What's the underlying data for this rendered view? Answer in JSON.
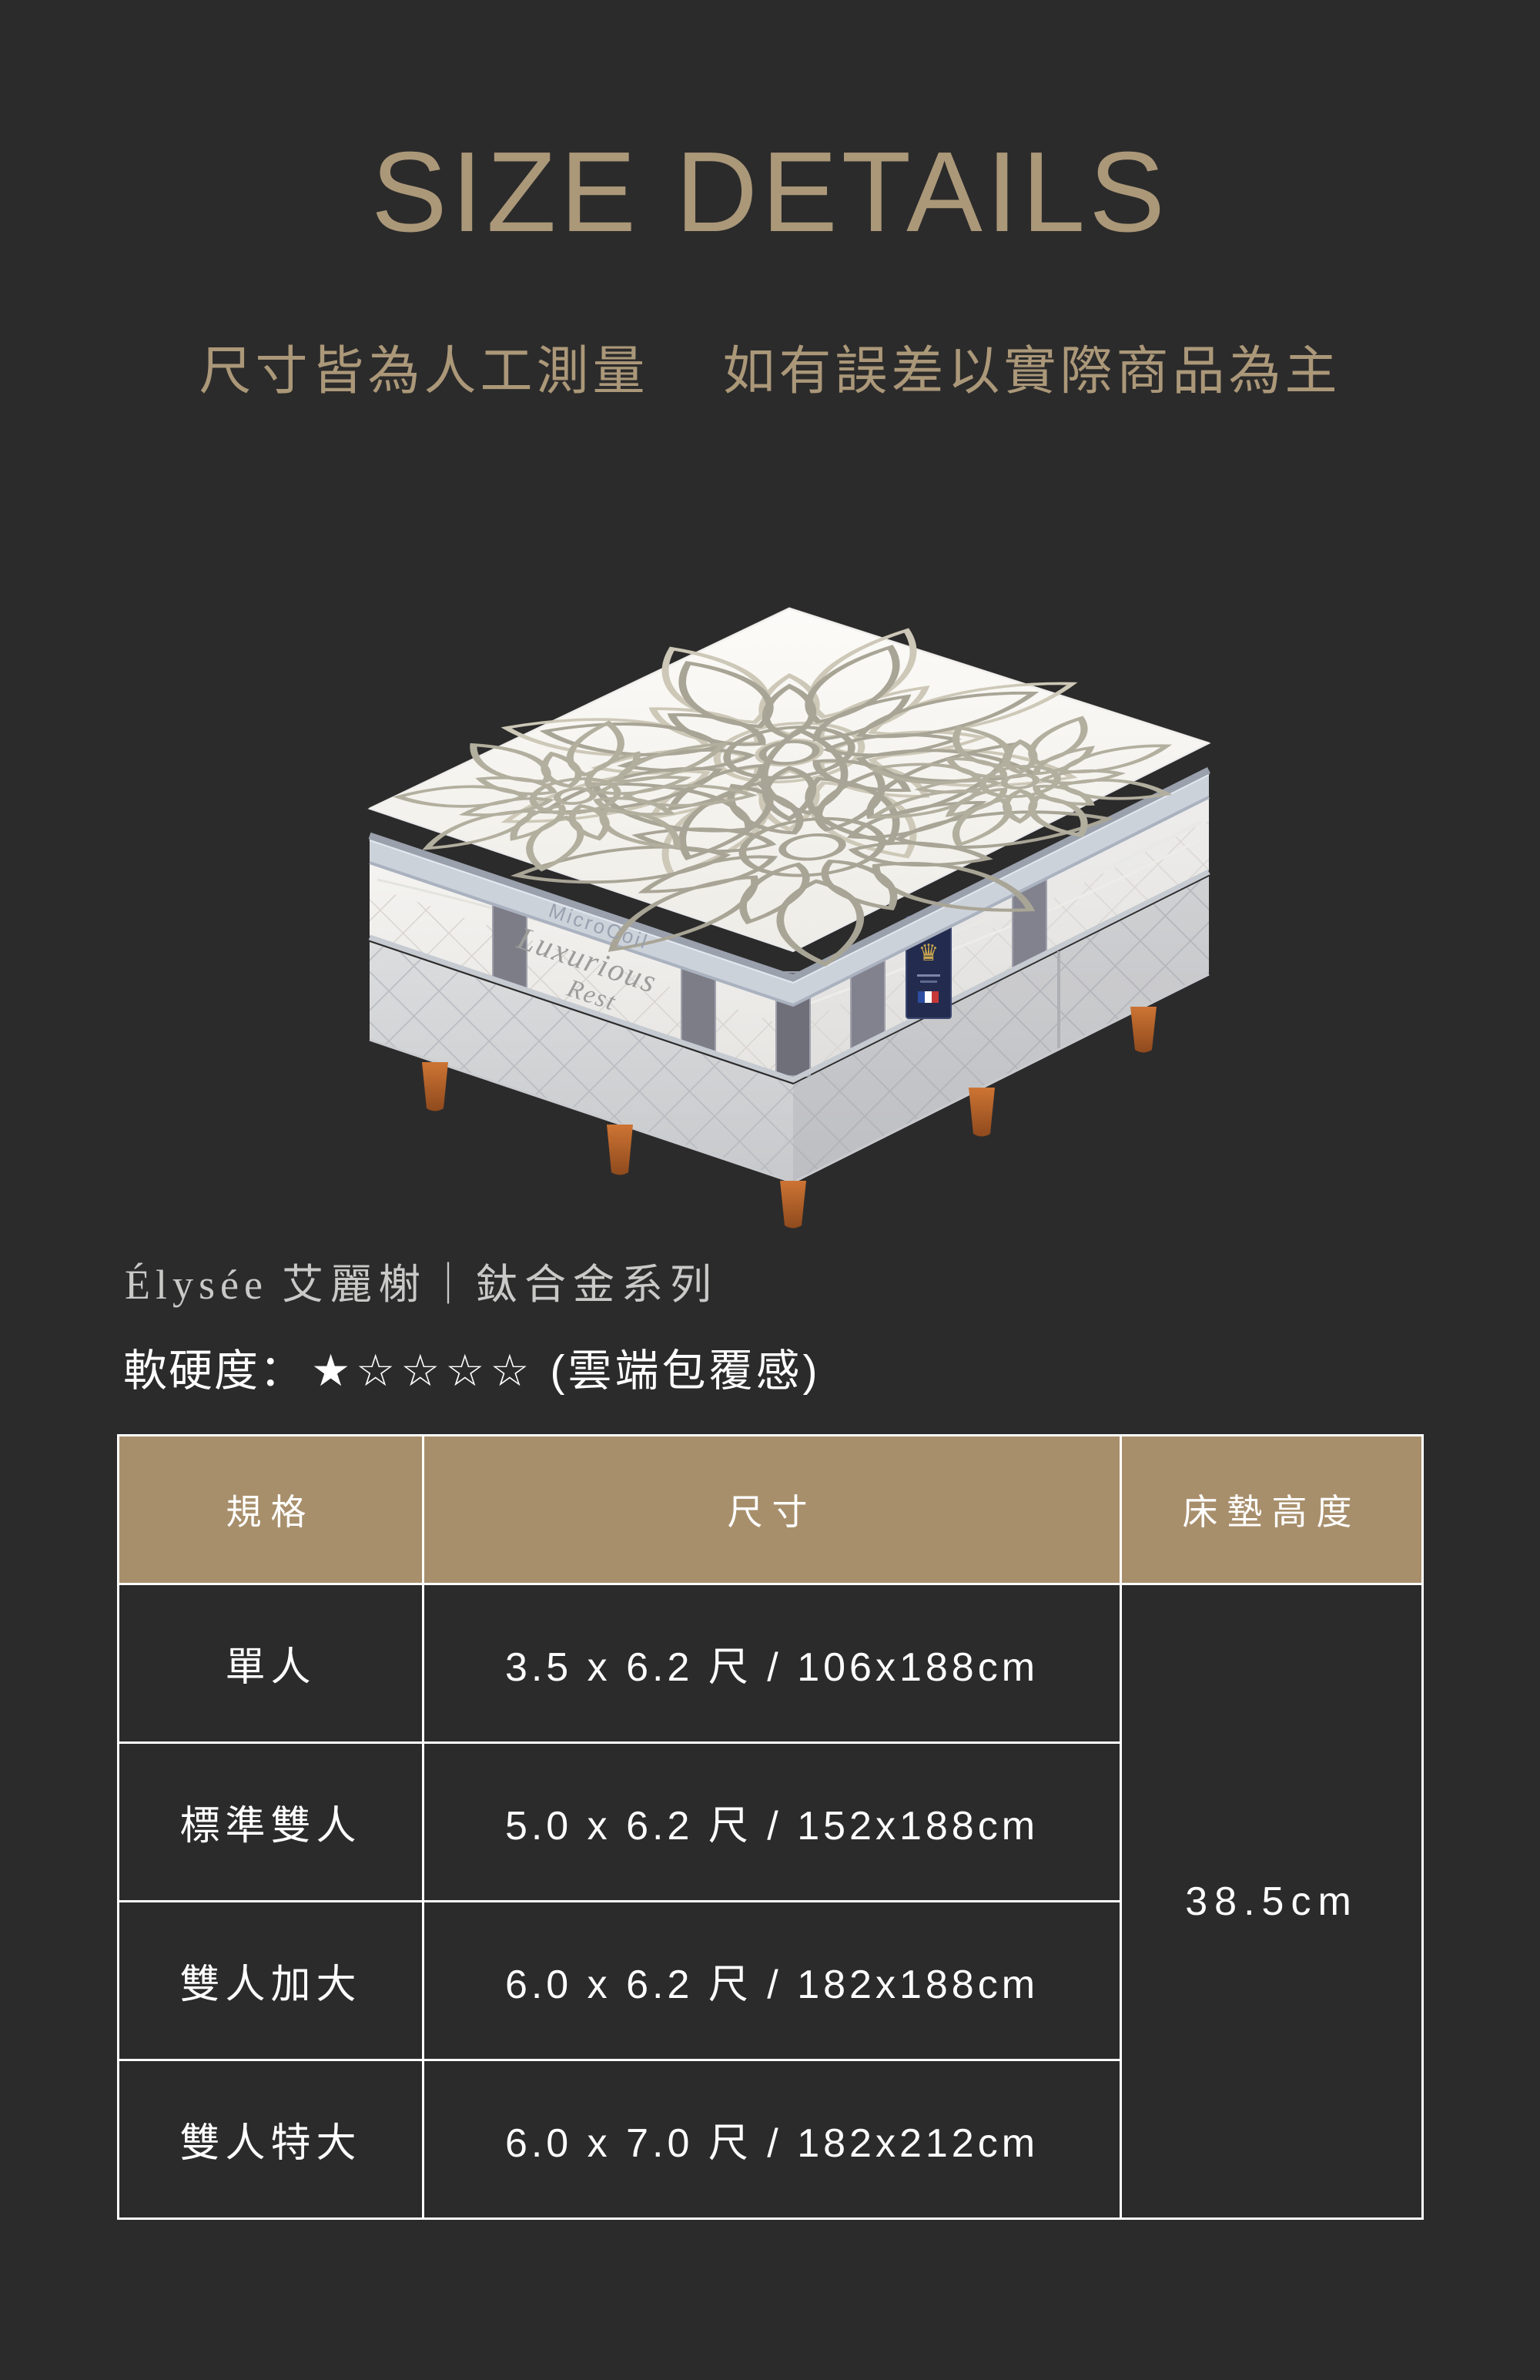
{
  "page": {
    "background": "#2c2b2b",
    "accent": "#ab9879"
  },
  "header": {
    "title": "SIZE DETAILS",
    "disclaimer_part1": "尺寸皆為人工測量",
    "disclaimer_part2": "如有誤差以實際商品為主"
  },
  "product": {
    "name_en": "Élysée",
    "name_zh": "艾麗榭｜鈦合金系列",
    "firmness_label": "軟硬度：",
    "firmness_stars": "★☆☆☆☆",
    "firmness_note": "(雲端包覆感)",
    "image_labels": {
      "pillow_band": "MicroCoil",
      "side_logo_line1": "Luxurious",
      "side_logo_line2": "Rest"
    }
  },
  "size_table": {
    "header_bg": "#a88f6c",
    "border_color": "#ffffff",
    "columns": {
      "spec": "規格",
      "size": "尺寸",
      "height": "床墊高度"
    },
    "rows": [
      {
        "spec": "單人",
        "size": "3.5 x 6.2 尺 / 106x188cm"
      },
      {
        "spec": "標準雙人",
        "size": "5.0 x 6.2 尺 / 152x188cm"
      },
      {
        "spec": "雙人加大",
        "size": "6.0 x 6.2 尺 / 182x188cm"
      },
      {
        "spec": "雙人特大",
        "size": "6.0 x 7.0 尺 / 182x212cm"
      }
    ],
    "mattress_height": "38.5cm"
  }
}
